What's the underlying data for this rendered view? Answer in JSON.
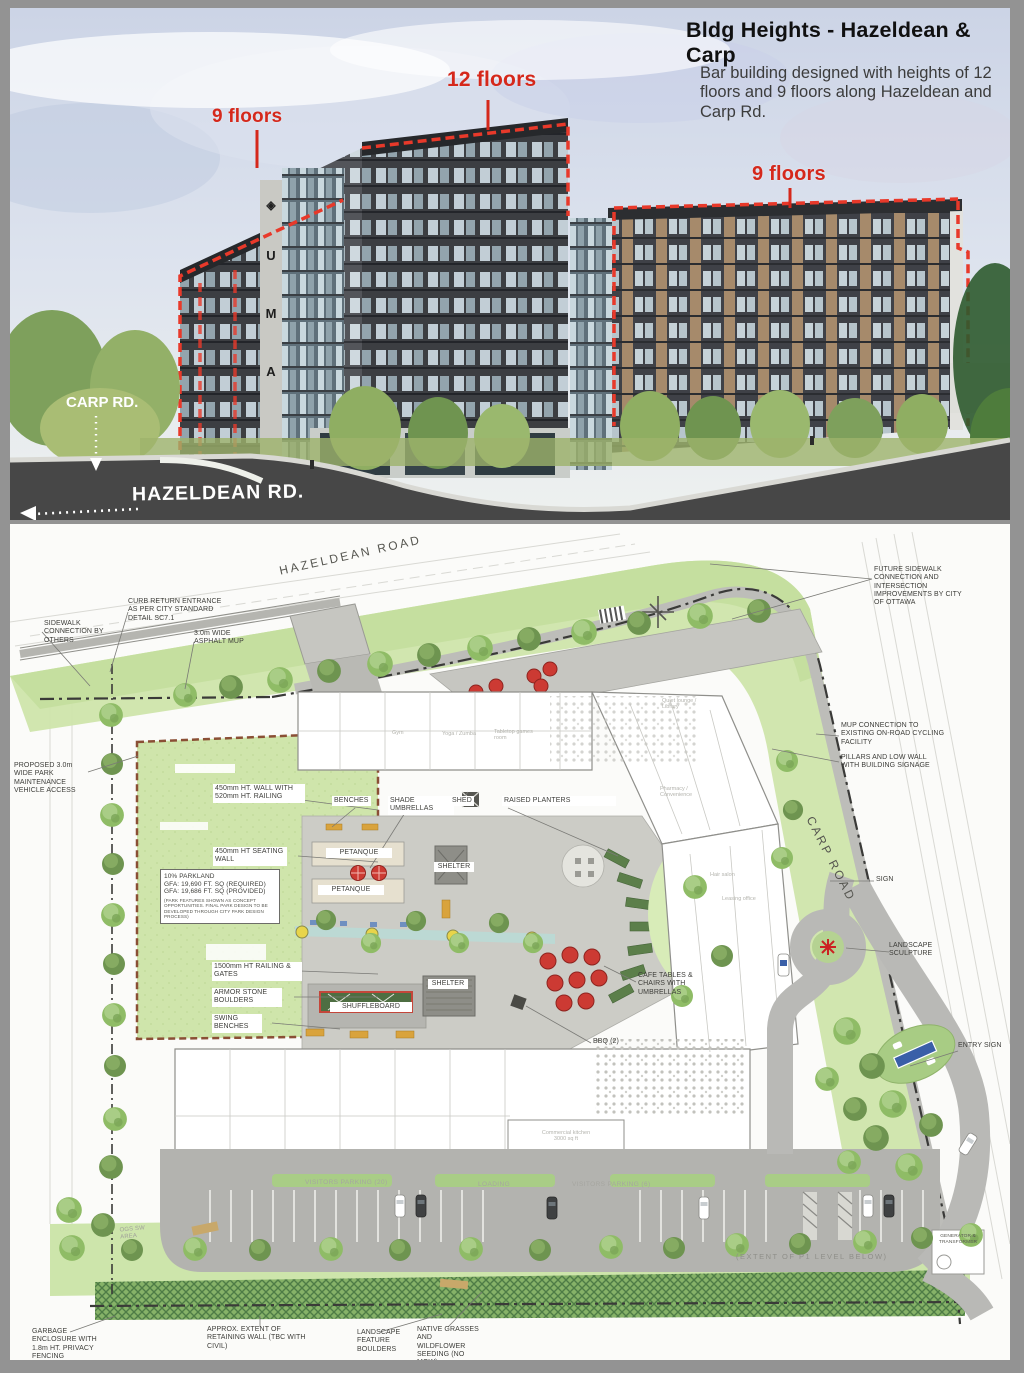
{
  "header": {
    "title": "Bldg Heights - Hazeldean & Carp",
    "body": "Bar building designed with heights of 12 floors and 9 floors along Hazeldean and Carp Rd."
  },
  "rendering": {
    "floors_left": "9 floors",
    "floors_center": "12 floors",
    "floors_right": "9 floors",
    "carp_rd": "CARP RD.",
    "hazeldean_rd": "HAZELDEAN RD.",
    "sign_logo": "◈",
    "sign_letters": [
      "U",
      "M",
      "A"
    ],
    "accent_color": "#d5281b"
  },
  "site": {
    "roads": {
      "hazeldean": "HAZELDEAN ROAD",
      "carp": "CARP ROAD"
    },
    "ann": {
      "sidewalk": "SIDEWALK CONNECTION BY OTHERS",
      "curb": "CURB RETURN ENTRANCE AS PER CITY STANDARD DETAIL SC7.1",
      "mup": "3.0m WIDE ASPHALT MUP",
      "future": "FUTURE SIDEWALK CONNECTION AND INTERSECTION IMPROVEMENTS BY CITY OF OTTAWA",
      "mup_conn": "MUP CONNECTION TO EXISTING ON-ROAD CYCLING FACILITY",
      "pillars": "PILLARS AND LOW WALL WITH BUILDING SIGNAGE",
      "sign": "SIGN",
      "sculpture": "LANDSCAPE SCULPTURE",
      "entry_sign": "ENTRY SIGN",
      "park_access": "PROPOSED 3.0m WIDE PARK MAINTENANCE VEHICLE ACCESS",
      "wall": "450mm HT. WALL WITH 520mm HT. RAILING",
      "seating": "450mm HT SEATING WALL",
      "parkland": [
        "10% PARKLAND",
        "GFA: 19,690 FT. SQ (REQUIRED)",
        "GFA: 19,686 FT. SQ (PROVIDED)",
        "(PARK FEATURES SHOWN AS CONCEPT OPPORTUNITIES. FINAL PARK DESIGN TO BE DEVELOPED THROUGH CITY PARK DESIGN PROCESS)"
      ],
      "railing": "1500mm HT RAILING & GATES",
      "armor": "ARMOR STONE BOULDERS",
      "swing": "SWING BENCHES",
      "benches": "BENCHES",
      "umbrellas": "SHADE UMBRELLAS",
      "shed": "SHED",
      "planters": "RAISED PLANTERS",
      "petanque": "PETANQUE",
      "shelter": "SHELTER",
      "shuffleboard": "SHUFFLEBOARD",
      "cafe": "CAFE TABLES & CHAIRS WITH UMBRELLAS",
      "bbq": "BBQ (2)",
      "garbage": "GARBAGE ENCLOSURE WITH 1.8m HT. PRIVACY FENCING",
      "retaining": "APPROX. EXTENT OF RETAINING WALL (TBC WITH CIVIL)",
      "boulders": "LANDSCAPE FEATURE BOULDERS",
      "grasses": "NATIVE GRASSES AND WILDFLOWER SEEDING (NO MOW)",
      "p1": "(EXTENT OF P1 LEVEL BELOW)",
      "generator": "GENERATOR & TRANSFORMER",
      "ogs": "OGS SW AREA"
    },
    "interior": {
      "gym": "Gym",
      "yoga": "Yoga / Zumba",
      "games": "Tabletop games room",
      "lounge": "Quiet lounge / Library",
      "pharmacy": "Pharmacy / Convenience",
      "hair": "Hair salon",
      "leasing": "Leasing office",
      "kitchen": "Commercial kitchen 3000 sq ft"
    },
    "parking": {
      "vp20": "VISITORS PARKING (20)",
      "loading": "LOADING",
      "vp6": "VISITORS PARKING (6)"
    }
  },
  "colors": {
    "annotation_red": "#d5281b",
    "park_green": "#cfe5ab",
    "tree_green": "#8fbc66",
    "road_gray": "#474747",
    "plan_paving": "#c9c9c4",
    "umbrella_red": "#cc3a33",
    "entry_sign_blue": "#3a5fa8"
  }
}
